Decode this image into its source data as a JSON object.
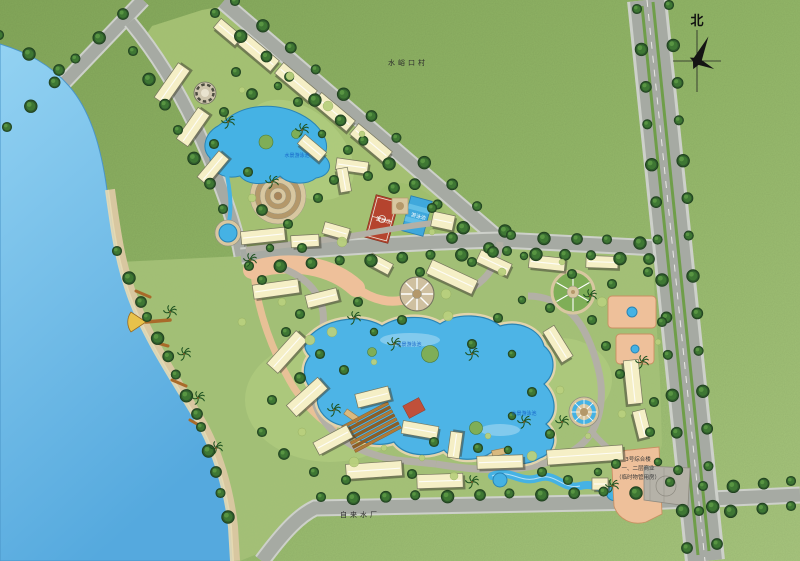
{
  "compass": {
    "label": "北"
  },
  "labels": {
    "village": "水峪口村",
    "water_plant": "自来水厂",
    "basketball_court": "篮球场",
    "swimming_pool": "游泳池",
    "upper_water": "水景游泳池",
    "central_lake": "水景游泳池",
    "southeast_water": "水景游泳池",
    "building3_line1": "3号综合楼",
    "building3_line2": "一、二层商业",
    "building3_line3": "（临时物管用房）"
  },
  "palette": {
    "grass_light": "#a8c67e",
    "grass_dark": "#82a756",
    "site_lawn": "#a6c274",
    "lake_top": "#93d2f2",
    "lake_bottom": "#55a9de",
    "pool_blue": "#45b2e4",
    "road_gray": "#a6aaa3",
    "highway_gray": "#9aa098",
    "median_green": "#6f9e4a",
    "building_cream": "#f5efc6",
    "building_edge": "#77775e",
    "paving_salmon": "#eec09a",
    "plaza_tan": "#d8c7a0",
    "plaza_brown": "#b4986a",
    "sand": "#ddd0a8",
    "court_red": "#b5442e",
    "wood_brown": "#a96a2a",
    "tree_dark": "#2e5a2b",
    "label_blue": "#1565c8",
    "ink": "#2b2b2b"
  }
}
